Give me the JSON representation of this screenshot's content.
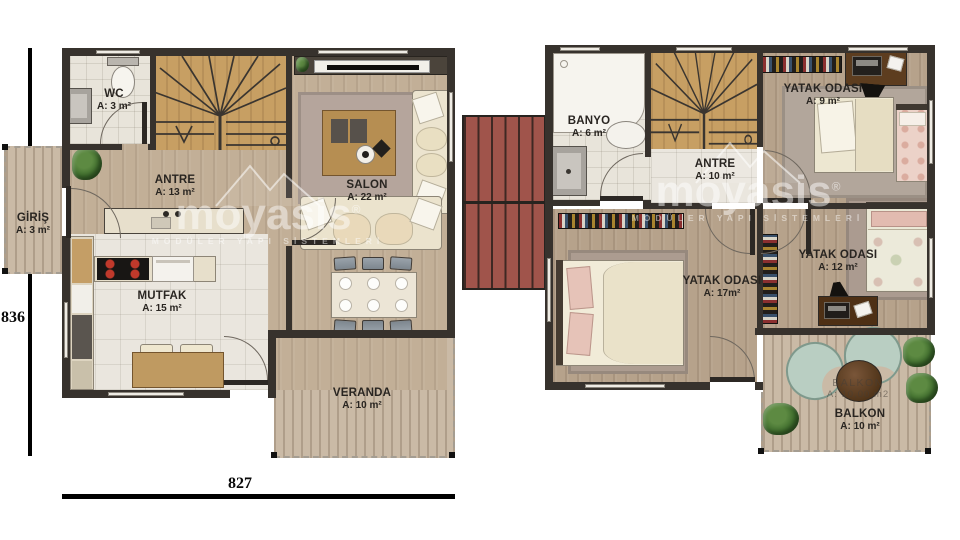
{
  "dimensions": {
    "height": "836",
    "width": "827"
  },
  "watermark": {
    "logo": "moyasis",
    "reg": "®",
    "tagline": "MODÜLER YAPI SİSTEMLERİ"
  },
  "floor1": {
    "wc": {
      "name": "WC",
      "area": "A: 3 m²"
    },
    "antre": {
      "name": "ANTRE",
      "area": "A: 13 m²"
    },
    "salon": {
      "name": "SALON",
      "area": "A: 22 m²"
    },
    "giris": {
      "name": "GİRİŞ",
      "area": "A: 3 m²"
    },
    "mutfak": {
      "name": "MUTFAK",
      "area": "A: 15 m²"
    },
    "veranda": {
      "name": "VERANDA",
      "area": "A: 10 m²"
    }
  },
  "floor2": {
    "banyo": {
      "name": "BANYO",
      "area": "A: 6 m²"
    },
    "antre": {
      "name": "ANTRE",
      "area": "A: 10 m²"
    },
    "yatak_odasi_9": {
      "name": "YATAK ODASI",
      "area": "A: 9 m²"
    },
    "yatak_odasi_12": {
      "name": "YATAK ODASI",
      "area": "A: 12 m²"
    },
    "yatak_odasi_17": {
      "name": "YATAK ODASI",
      "area": "A: 17m²"
    },
    "balkon": {
      "name": "BALKON",
      "area": "A: 10 m²"
    },
    "balkon_alt": {
      "name": "BALKON",
      "area": "A: 10,00 m2"
    }
  },
  "colors": {
    "wall": "#37322d",
    "roof_red": "#a0544b",
    "wood_floor_ground": "#c2af97",
    "wood_floor_upper": "#b6a28b",
    "stairs_wood": "#c79f63",
    "tile": "#eae6de",
    "deck": "#cabaa6",
    "teal_chair": "#b9cec2",
    "watermark": "#ffffff"
  }
}
